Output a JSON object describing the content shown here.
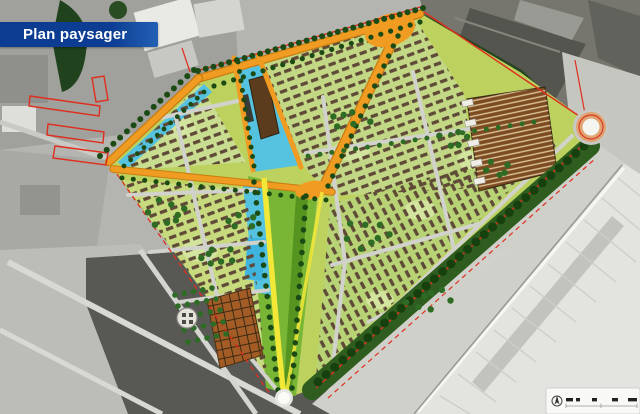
{
  "banner": {
    "title": "Plan paysager"
  },
  "figure": {
    "description": "Landscape masterplan drawn in colour over a grayscale aerial photograph"
  },
  "colors": {
    "banner_blue": "#0c3d92",
    "banner_blue_light": "#2260b4",
    "road_orange": "#f09c22",
    "road_orange_dark": "#c97c10",
    "path_yellow": "#f2e838",
    "water_cyan": "#55c3e0",
    "plan_base": "#bdd25e",
    "lawn_light": "#d6e6a6",
    "meadow_green": "#8cc23c",
    "corridor_green": "#7ab636",
    "tree_dark": "#1c4a14",
    "band_green": "#2f5d1f",
    "band_blob": "#17400f",
    "tree_mid": "#2e6b24",
    "housing_brown": "#5f4a38",
    "allotment_brown": "#7c4b22",
    "orchard_brown": "#a35c25",
    "boundary_red": "#df2f1e",
    "aerial_gray": "#b4b4b0",
    "warehouse_gray": "#e3e3df",
    "street_gray": "#d2d2cc"
  },
  "legend": {
    "items": [
      "north-arrow-icon",
      "scale-bar-icon"
    ]
  }
}
